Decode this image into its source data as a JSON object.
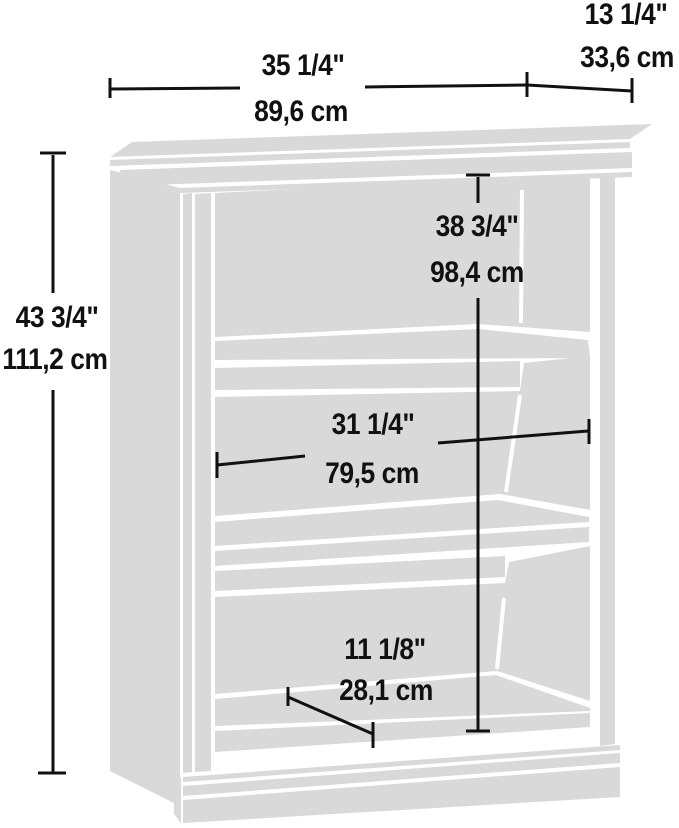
{
  "diagram": {
    "type": "furniture-dimension-diagram",
    "subject": "3-shelf bookcase line drawing with measurements",
    "colors": {
      "furniture": "#d9d9d9",
      "lines": "#111111",
      "background": "#ffffff"
    },
    "dimensions": {
      "overall_width": {
        "inches": "35 1/4\"",
        "cm": "89,6 cm"
      },
      "depth": {
        "inches": "13 1/4\"",
        "cm": "33,6 cm"
      },
      "overall_height": {
        "inches": "43 3/4\"",
        "cm": "111,2 cm"
      },
      "interior_height": {
        "inches": "38 3/4\"",
        "cm": "98,4 cm"
      },
      "interior_width": {
        "inches": "31 1/4\"",
        "cm": "79,5 cm"
      },
      "bottom_opening_height": {
        "inches": "11 1/8\"",
        "cm": "28,1 cm"
      }
    }
  }
}
